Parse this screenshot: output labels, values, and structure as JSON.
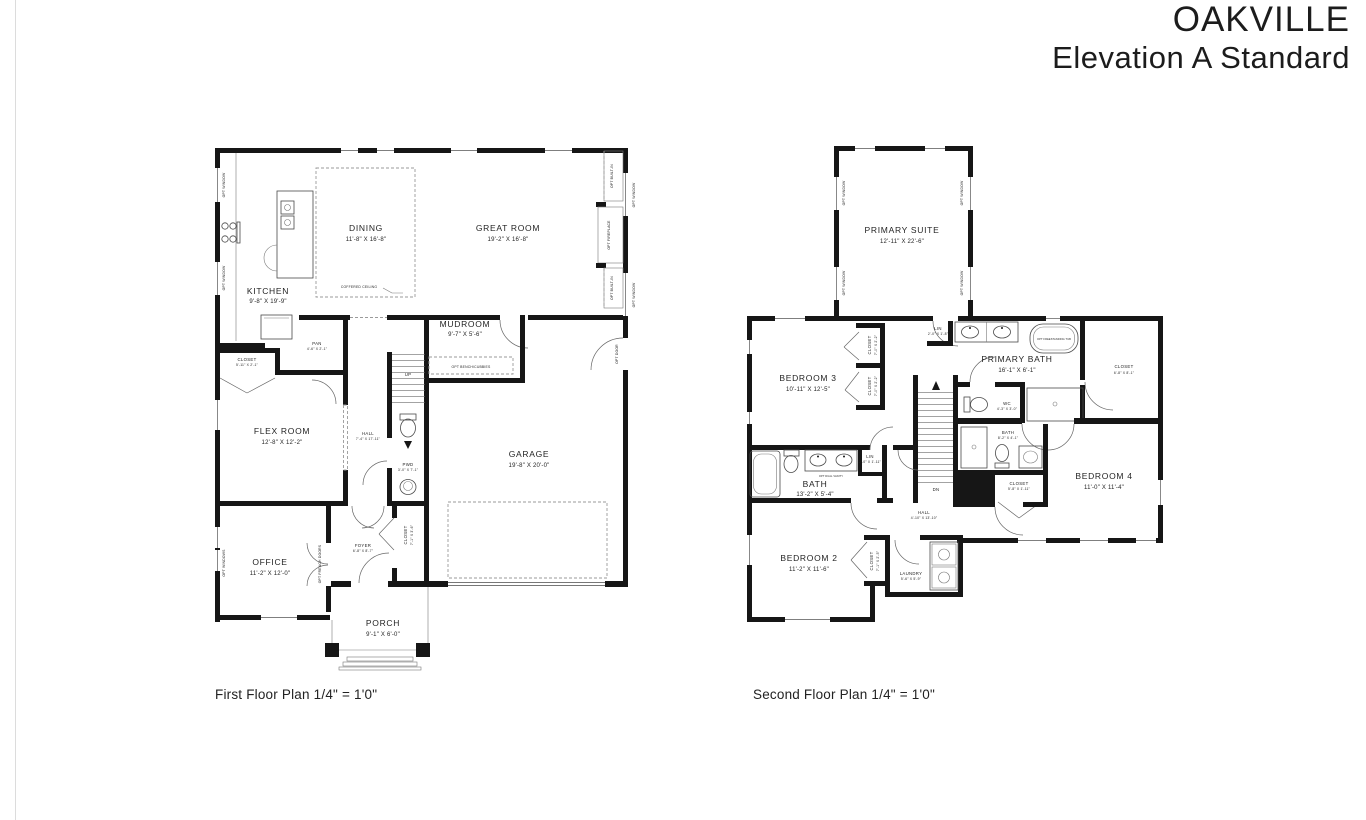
{
  "page": {
    "title_line1": "OAKVILLE",
    "title_line2": "Elevation A Standard"
  },
  "first_floor": {
    "caption": "First Floor Plan 1/4\" = 1'0\"",
    "rooms": {
      "kitchen": {
        "name": "KITCHEN",
        "dims": "9'-8\" X 19'-9\""
      },
      "dining": {
        "name": "DINING",
        "dims": "11'-8\" X 16'-8\""
      },
      "great_room": {
        "name": "GREAT ROOM",
        "dims": "19'-2\" X 16'-8\""
      },
      "mudroom": {
        "name": "MUDROOM",
        "dims": "9'-7\" X 5'-6\""
      },
      "flex_room": {
        "name": "FLEX ROOM",
        "dims": "12'-8\" X 12'-2\""
      },
      "garage": {
        "name": "GARAGE",
        "dims": "19'-8\" X 20'-0\""
      },
      "office": {
        "name": "OFFICE",
        "dims": "11'-2\" X 12'-0\""
      },
      "porch": {
        "name": "PORCH",
        "dims": "9'-1\" X 6'-0\""
      },
      "hall": {
        "name": "HALL",
        "dims": "7'-4\" X 17'-11\""
      },
      "pwd": {
        "name": "PWD",
        "dims": "3'-0\" X 7'-1\""
      },
      "foyer": {
        "name": "FOYER",
        "dims": "6'-8\" X 8'-7\""
      },
      "closet": {
        "name": "CLOSET",
        "dims": "5'-11\" X 2'-1\""
      },
      "pantry": {
        "name": "PAN",
        "dims": "4'-6\" X 2'-1\""
      },
      "foyer_closet": {
        "name": "CLOSET",
        "dims": "7'-1\" X 3'-6\""
      }
    },
    "notes": {
      "coffered_ceiling": "COFFERED CEILING",
      "opt_bench": "OPT BENCH/CUBBIES",
      "up": "UP",
      "opt_window": "OPT WINDOW",
      "opt_windows": "OPT WINDOWS",
      "opt_built_in": "OPT BUILT-IN",
      "opt_fireplace": "OPT FIREPLACE",
      "opt_door": "OPT DOOR",
      "opt_french_doors": "OPT FRENCH DOORS"
    }
  },
  "second_floor": {
    "caption": "Second Floor Plan 1/4\" = 1'0\"",
    "rooms": {
      "primary_suite": {
        "name": "PRIMARY SUITE",
        "dims": "12'-11\" X 22'-6\""
      },
      "bedroom2": {
        "name": "BEDROOM 2",
        "dims": "11'-2\" X 11'-6\""
      },
      "bedroom3": {
        "name": "BEDROOM 3",
        "dims": "10'-11\" X 12'-5\""
      },
      "bedroom4": {
        "name": "BEDROOM 4",
        "dims": "11'-0\" X 11'-4\""
      },
      "primary_bath": {
        "name": "PRIMARY BATH",
        "dims": "16'-1\" X 6'-1\""
      },
      "bath": {
        "name": "BATH",
        "dims": "13'-2\" X 5'-4\""
      },
      "bath4": {
        "name": "BATH",
        "dims": "8'-2\" X 4'-1\""
      },
      "wc": {
        "name": "WC",
        "dims": "4'-3\" X 3'-0\""
      },
      "hall": {
        "name": "HALL",
        "dims": "4'-10\" X 13'-10\""
      },
      "laundry": {
        "name": "LAUNDRY",
        "dims": "5'-6\" X 5'-9\""
      },
      "primary_closet": {
        "name": "CLOSET",
        "dims": "6'-8\" X 8'-1\""
      },
      "closet3a": {
        "name": "CLOSET",
        "dims": "7'-0\" X 2'-2\""
      },
      "closet3b": {
        "name": "CLOSET",
        "dims": "7'-0\" X 2'-2\""
      },
      "closet2": {
        "name": "CLOSET",
        "dims": "7'-1\" X 2'-5\""
      },
      "closet4": {
        "name": "CLOSET",
        "dims": "5'-8\" X 1'-11\""
      },
      "lin_primary": {
        "name": "LIN",
        "dims": "2'-0\" X 1'-8\""
      },
      "lin_bath": {
        "name": "LIN",
        "dims": "2'-0\" X 1'-11\""
      }
    },
    "notes": {
      "opt_window": "OPT WINDOW",
      "opt_dual_vanity": "OPT DUAL VANITY",
      "opt_tub": "OPT FREESTANDING TUB",
      "dn": "DN"
    }
  }
}
